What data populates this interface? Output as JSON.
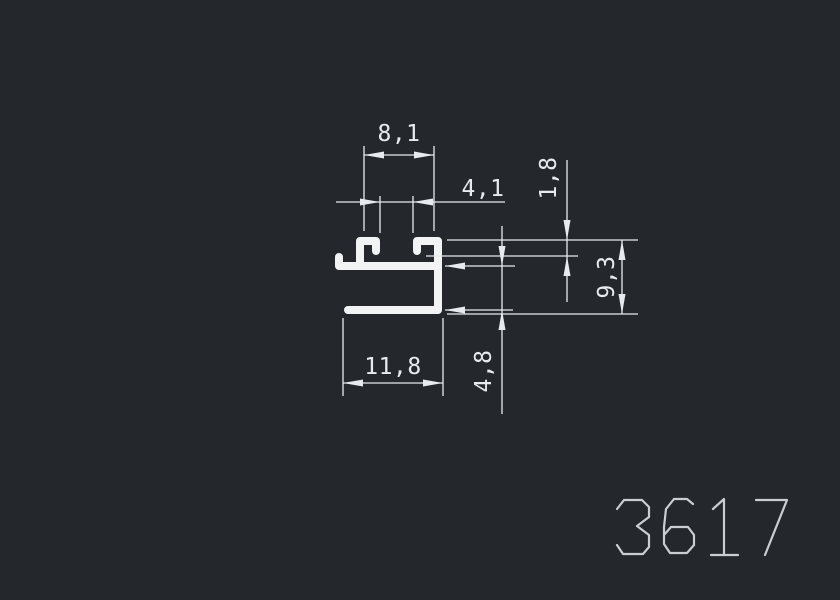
{
  "canvas": {
    "background": "#24272c"
  },
  "profile": {
    "number": "3617",
    "line_color": "#f1f3f5",
    "label_color": "#c9ced4"
  },
  "dims": {
    "color": "#e8ebee",
    "slot_inner_width": "8,1",
    "slot_opening": "4,1",
    "lip_height": "1,8",
    "overall_height": "9,3",
    "overall_width": "11,8",
    "lower_cavity_height": "4,8"
  }
}
